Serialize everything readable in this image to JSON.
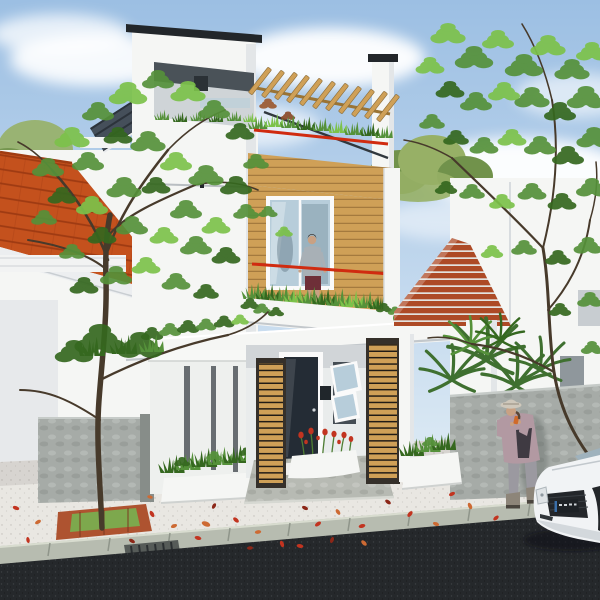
{
  "meta": {
    "type": "architectural-rendering",
    "description": "3D exterior rendering of a modern three-storey white house with wood slat accents, rooftop pergola terrace, balcony, street with scattered red petals, a white car and two people",
    "canvas": {
      "w": 600,
      "h": 600
    }
  },
  "palette": {
    "sky_top": "#9cbfe3",
    "sky_horizon": "#d8e7f3",
    "cloud": "#ffffff",
    "wall_white": "#f5f6f4",
    "wall_shade": "#e3e6e8",
    "wall_dark_shade": "#c8cdd1",
    "roof_cap": "#22262a",
    "slate_roof": "#454f5a",
    "wood_slat": "#cfa057",
    "wood_slat_dark": "#9a7435",
    "orange_roof": "#c4511d",
    "red_slat_roof": "#ad4a26",
    "railing_red": "#d02b10",
    "glass": "#b7cdda",
    "glass_dark": "#87a0ad",
    "door_dark": "#242c35",
    "plant_green": "#55913a",
    "plant_light": "#7cc24a",
    "plant_dark": "#35681f",
    "palm_green": "#3f7030",
    "bg_tree": "#97b066",
    "bg_tree_dark": "#71924b",
    "concrete": "#a6aba7",
    "concrete_dark": "#878d89",
    "fence_white": "#eef0ee",
    "fence_gap": "#686d71",
    "pavement": "#e9e7e2",
    "pavement_shade": "#d2d0cc",
    "platform_gray": "#b7bab3",
    "curb": "#b7bcb0",
    "asphalt": "#25282b",
    "petal_red": "#c23420",
    "petal_orange": "#cd6a33",
    "petal_dark": "#8c2718",
    "brick": "#ae5330",
    "grass_green": "#7da84d",
    "trunk": "#473a2b",
    "skin": "#c9a183",
    "hat": "#cfc8bb",
    "jacket_mauve": "#b299a2",
    "top_dark": "#3f3a42",
    "pants_gray": "#9b99a0",
    "boots": "#8d8579",
    "tee_gray": "#a8b0b6",
    "shorts": "#6e2f38",
    "car_white": "#f1f3f5",
    "car_grille": "#23262a",
    "plate_dark": "#1d2125",
    "strut_dark": "#31383e"
  },
  "scene": {
    "setting": "daytime street view, blue sky with soft clouds",
    "buildings": {
      "main_house": {
        "stories": 3,
        "features": [
          "rooftop box volume with recessed terrace opening",
          "wooden pergola with angled rafters",
          "red terrace and balcony railings",
          "horizontal wood slat facade",
          "balcony with ornamental grasses",
          "large picture window",
          "dark glass entry door",
          "two tilted-open awning windows",
          "two vertical wood slat privacy screens",
          "wide white porch slab with hedge"
        ]
      },
      "left_house": {
        "features": [
          "orange tiled pitched roof",
          "white walls",
          "white eave band"
        ]
      },
      "right_house": {
        "features": [
          "sloped red-brown slat roof",
          "white walls",
          "gray window openings",
          "gray concrete boundary wall"
        ]
      }
    },
    "people": [
      {
        "name": "man-on-balcony",
        "description": "man in gray t-shirt and dark shorts standing on the first-floor balcony"
      },
      {
        "name": "woman-on-phone",
        "description": "woman in light hat and mauve jacket talking on a phone in front of the gray wall"
      }
    ],
    "vehicles": [
      {
        "name": "white-car",
        "description": "front of a white car with dark grille and plate, parked lower right"
      }
    ],
    "landscape": [
      "large foreground tree in square brick planter",
      "bamboo-like tree upper right",
      "palm shrubs behind boundary wall",
      "white planter boxes with shrubs",
      "red flowers by the entry",
      "scattered red and orange petals on pale pavement",
      "gray-green curb with drain grate",
      "dark asphalt road"
    ]
  }
}
